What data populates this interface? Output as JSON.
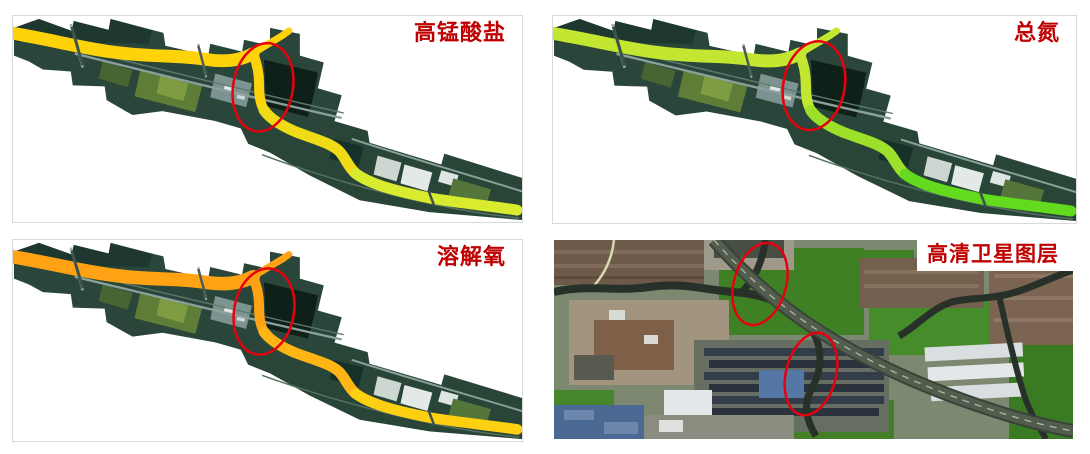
{
  "page": {
    "background": "#ffffff"
  },
  "colors": {
    "label_red": "#c00000",
    "annotation_red": "#e8000d",
    "panel_border": "#d9d9d9"
  },
  "panels": {
    "permanganate": {
      "label": "高锰酸盐",
      "river_upstream": "#ffd30a",
      "river_mid": "#f0dc16",
      "river_downstream": "#d9eb2e"
    },
    "total_nitrogen": {
      "label": "总氮",
      "river_upstream": "#c3e731",
      "river_mid": "#9ce02a",
      "river_downstream": "#63da1d"
    },
    "dissolved_oxygen": {
      "label": "溶解氧",
      "river_upstream": "#ffa214",
      "river_mid": "#ffb513",
      "river_downstream": "#ffd012"
    },
    "hd_satellite": {
      "label": "高清卫星图层"
    }
  }
}
